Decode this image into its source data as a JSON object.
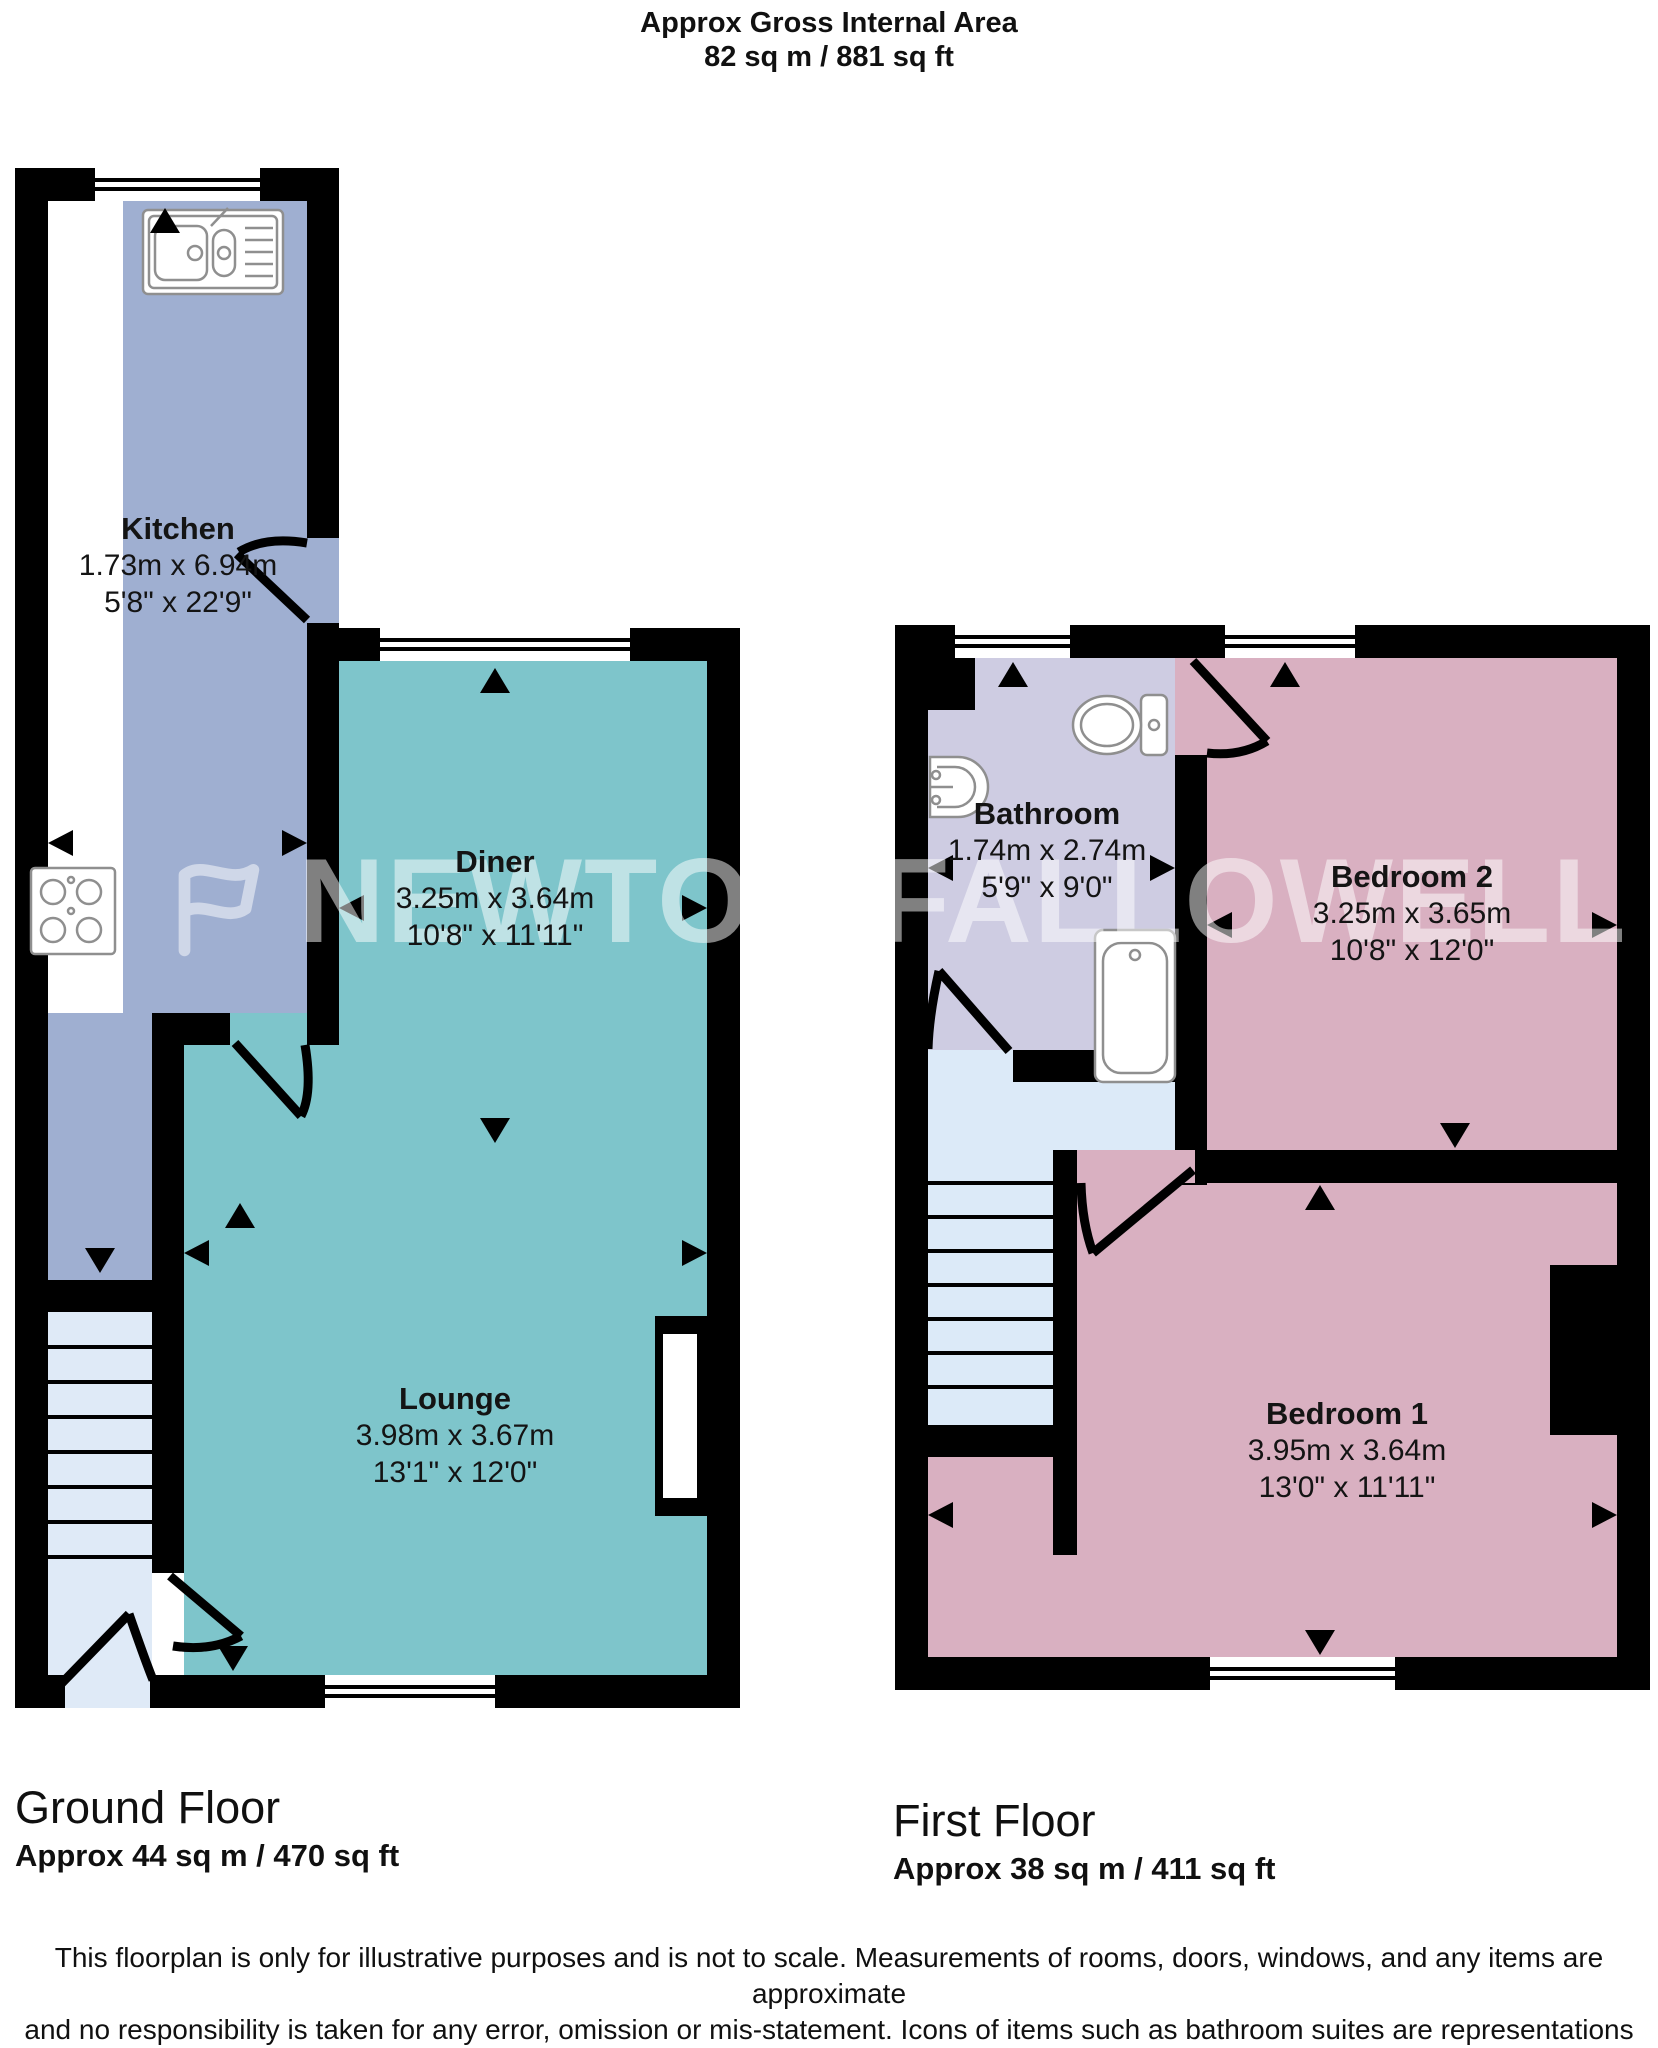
{
  "header": {
    "title": "Approx Gross Internal Area",
    "area": "82 sq m / 881 sq ft"
  },
  "ground_floor": {
    "caption": "Ground Floor",
    "area": "Approx 44 sq m / 470 sq ft",
    "rooms": [
      {
        "name": "Kitchen",
        "metric": "1.73m x 6.94m",
        "imperial": "5'8\" x 22'9\""
      },
      {
        "name": "Diner",
        "metric": "3.25m x 3.64m",
        "imperial": "10'8\" x 11'11\""
      },
      {
        "name": "Lounge",
        "metric": "3.98m x 3.67m",
        "imperial": "13'1\" x 12'0\""
      }
    ]
  },
  "first_floor": {
    "caption": "First Floor",
    "area": "Approx 38 sq m / 411 sq ft",
    "rooms": [
      {
        "name": "Bathroom",
        "metric": "1.74m x 2.74m",
        "imperial": "5'9\" x 9'0\""
      },
      {
        "name": "Bedroom 2",
        "metric": "3.25m x 3.65m",
        "imperial": "10'8\" x 12'0\""
      },
      {
        "name": "Bedroom 1",
        "metric": "3.95m x 3.64m",
        "imperial": "13'0\" x 11'11\""
      }
    ]
  },
  "watermark": "NEWTON FALLOWELL",
  "disclaimer": {
    "lines": [
      "This floorplan is only for illustrative purposes and is not to scale. Measurements of rooms, doors, windows, and any items are approximate",
      "and no responsibility is taken for any error, omission or mis-statement. Icons of items such as bathroom suites are representations only and",
      "may not look like the real items. Made with Made Snappy 360."
    ]
  },
  "colors": {
    "kitchen": "#9fafd1",
    "living": "#7ec5cb",
    "bedroom": "#d9b0c1",
    "bathroom": "#cecce2",
    "stairs_hall": "#dfeaf7",
    "landing": "#dceaf8",
    "walls": "#000000"
  }
}
